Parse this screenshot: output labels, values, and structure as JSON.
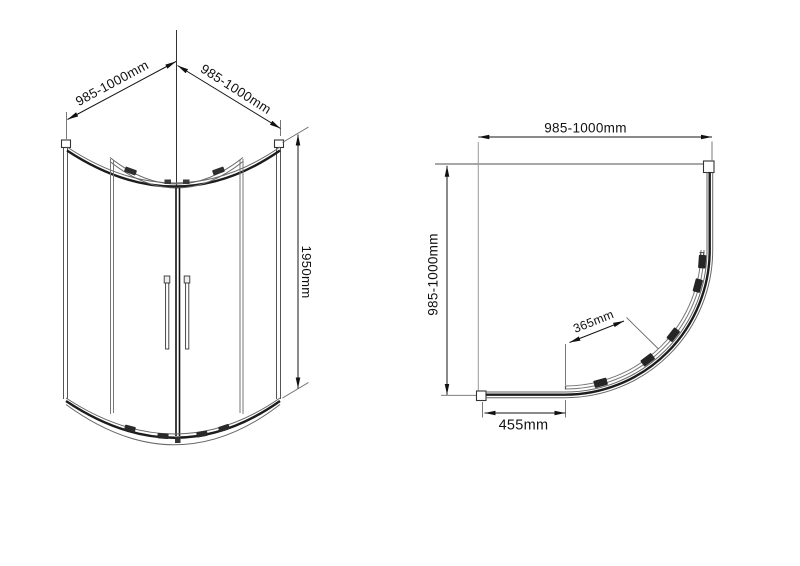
{
  "document": {
    "type": "shower-enclosure-technical-drawing",
    "background_color": "#ffffff",
    "line_color_dark": "#1c1c1c",
    "line_color_mid": "#555555",
    "line_color_wall": "#8a8a8a",
    "text_color": "#111111"
  },
  "front_view": {
    "name": "front-elevation",
    "dim_width_left": "985-1000mm",
    "dim_width_right": "985-1000mm",
    "dim_height": "1950mm"
  },
  "plan_view": {
    "name": "top-plan-view",
    "dim_width_top": "985-1000mm",
    "dim_depth_left": "985-1000mm",
    "dim_door_opening": "365mm",
    "dim_side_panel": "455mm"
  }
}
